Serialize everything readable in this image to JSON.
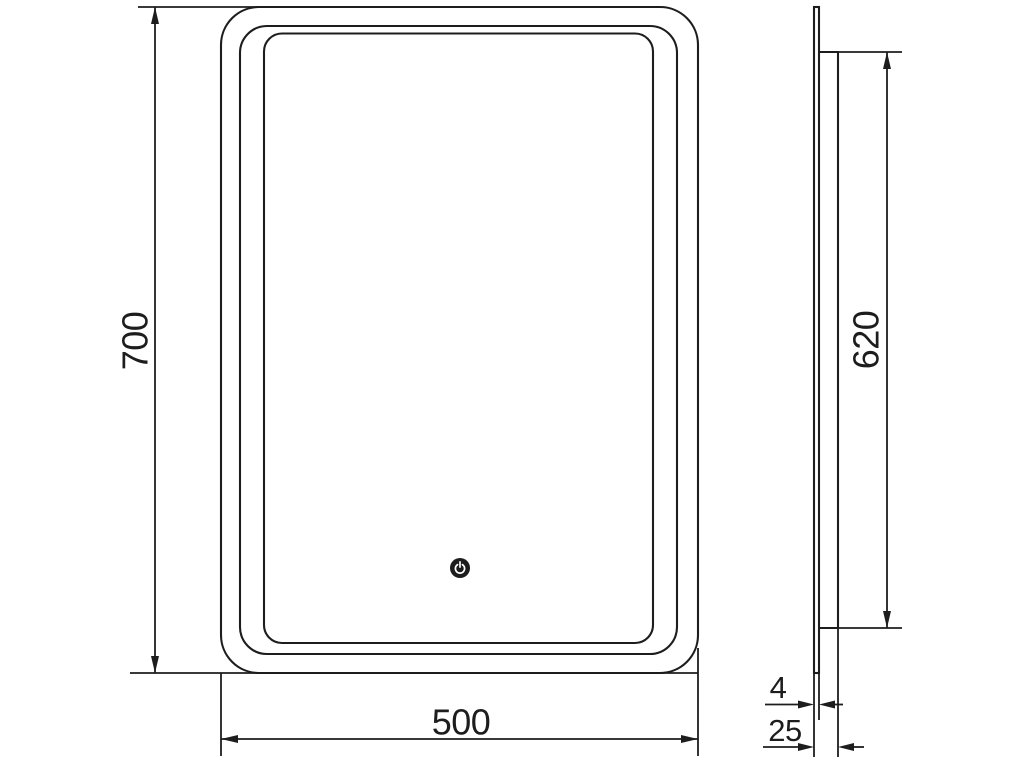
{
  "page": {
    "background_color": "#ffffff"
  },
  "diagram": {
    "line_color": "#1d1d1d",
    "power_glyph_color": "#ffffff",
    "views": {
      "front": {
        "height_dimension": "700",
        "width_dimension": "500"
      },
      "side": {
        "height_dimension": "620",
        "glass_thickness_dimension": "4",
        "depth_dimension": "25"
      }
    },
    "icons": {
      "power_button": "power-icon"
    }
  }
}
